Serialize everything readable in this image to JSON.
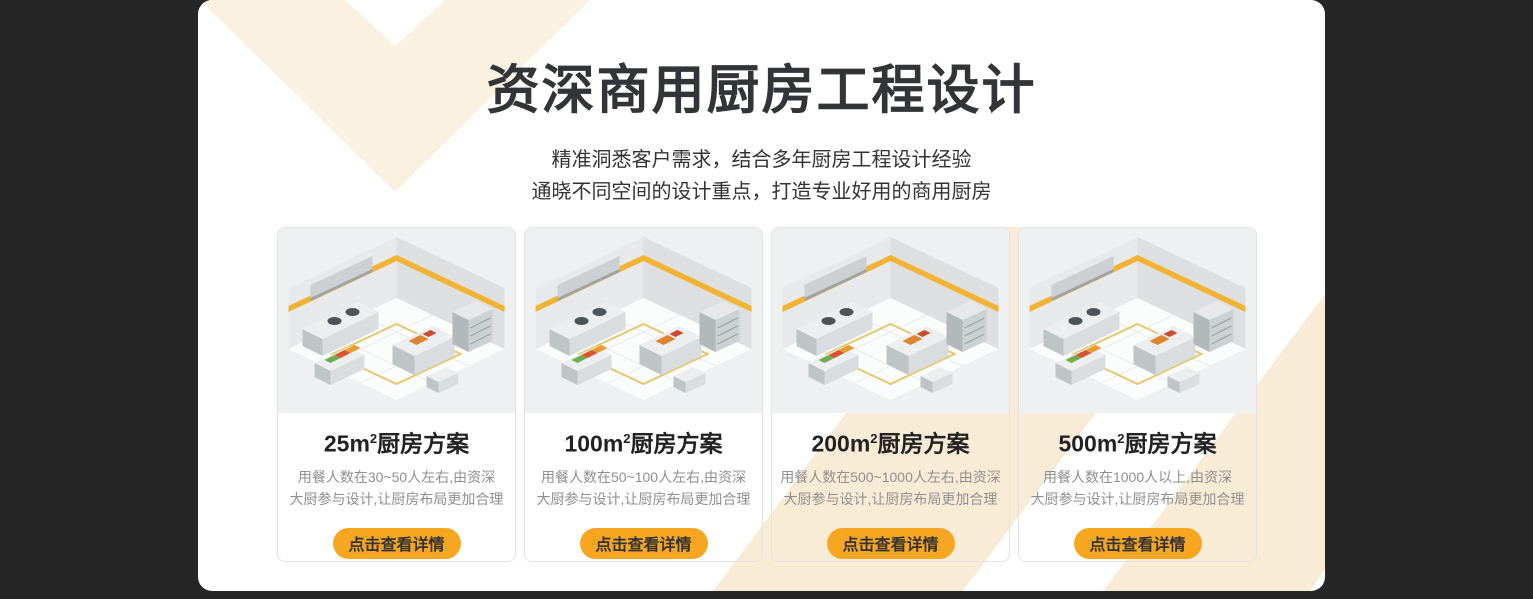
{
  "theme": {
    "background_color": "#262626",
    "panel_color": "#ffffff",
    "accent_orange": "#f7a621",
    "chevron_cream": "#f9ecd7",
    "card_border_color": "#e3e3e3"
  },
  "header": {
    "title": "资深商用厨房工程设计",
    "subtitle_line1": "精准洞悉客户需求，结合多年厨房工程设计经验",
    "subtitle_line2": "通晓不同空间的设计重点，打造专业好用的商用厨房"
  },
  "cards": [
    {
      "title_size": "25m",
      "title_sup": "2",
      "title_rest": "厨房方案",
      "desc_line1": "用餐人数在30~50人左右,由资深",
      "desc_line2": "大厨参与设计,让厨房布局更加合理",
      "button_label": "点击查看详情",
      "image_name": "isometric-kitchen-render-25sqm"
    },
    {
      "title_size": "100m",
      "title_sup": "2",
      "title_rest": "厨房方案",
      "desc_line1": "用餐人数在50~100人左右,由资深",
      "desc_line2": "大厨参与设计,让厨房布局更加合理",
      "button_label": "点击查看详情",
      "image_name": "isometric-kitchen-render-100sqm"
    },
    {
      "title_size": "200m",
      "title_sup": "2",
      "title_rest": "厨房方案",
      "desc_line1": "用餐人数在500~1000人左右,由资深",
      "desc_line2": "大厨参与设计,让厨房布局更加合理",
      "button_label": "点击查看详情",
      "image_name": "isometric-kitchen-render-200sqm"
    },
    {
      "title_size": "500m",
      "title_sup": "2",
      "title_rest": "厨房方案",
      "desc_line1": "用餐人数在1000人以上,由资深",
      "desc_line2": "大厨参与设计,让厨房布局更加合理",
      "button_label": "点击查看详情",
      "image_name": "isometric-kitchen-render-500sqm"
    }
  ]
}
